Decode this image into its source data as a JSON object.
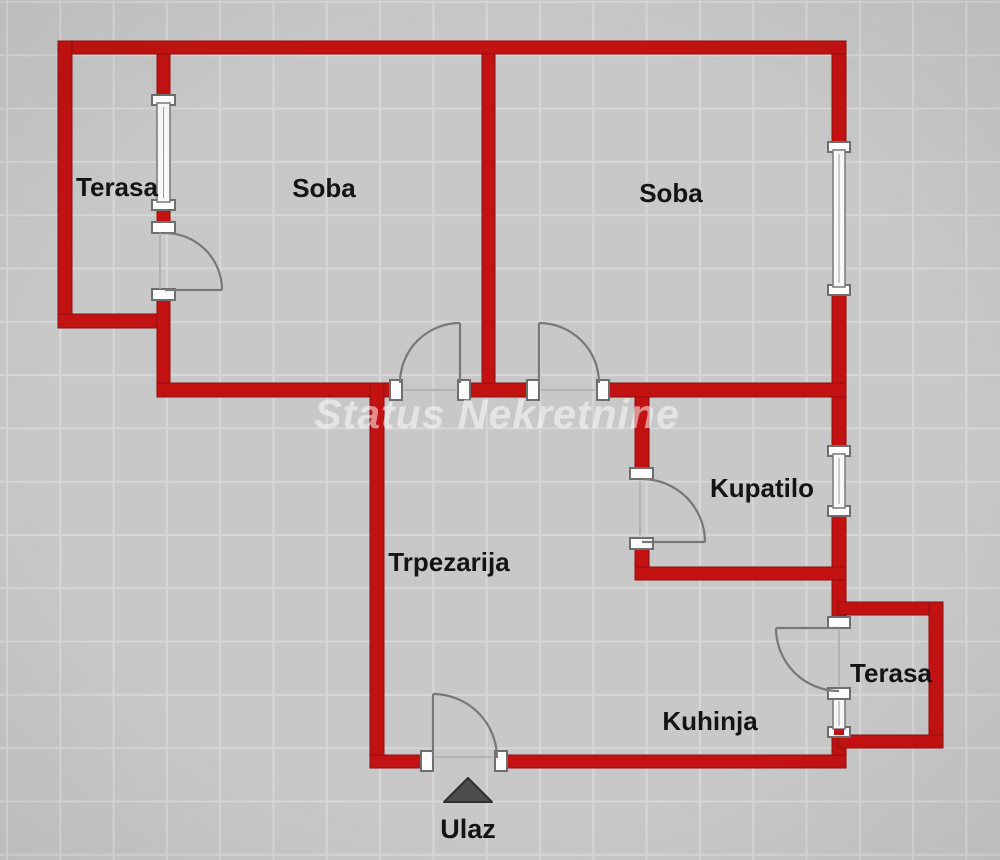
{
  "watermark": "Status Nekretnine",
  "rooms": {
    "terasa_top": "Terasa",
    "soba_left": "Soba",
    "soba_right": "Soba",
    "kupatilo": "Kupatilo",
    "trpezarija": "Trpezarija",
    "kuhinja": "Kuhinja",
    "terasa_bottom": "Terasa",
    "entrance": "Ulaz"
  },
  "colors": {
    "wall": "#c31212",
    "wall_edge": "#8f0d0d",
    "background": "#c8c8c8",
    "grid_line": "#d7d7d7",
    "label_text": "#141414",
    "watermark_text": "#ffffff",
    "door_swing": "#787878",
    "window_fill": "#f8f8f8",
    "entrance_arrow": "#4d4d4d"
  },
  "elements": {
    "doors": [
      "terasa-to-soba",
      "soba-left",
      "soba-right",
      "kupatilo",
      "kuhinja-to-terasa",
      "entrance"
    ],
    "windows": [
      "terasa-partition",
      "soba-right-east",
      "kupatilo-east",
      "kuhinja-east"
    ]
  }
}
